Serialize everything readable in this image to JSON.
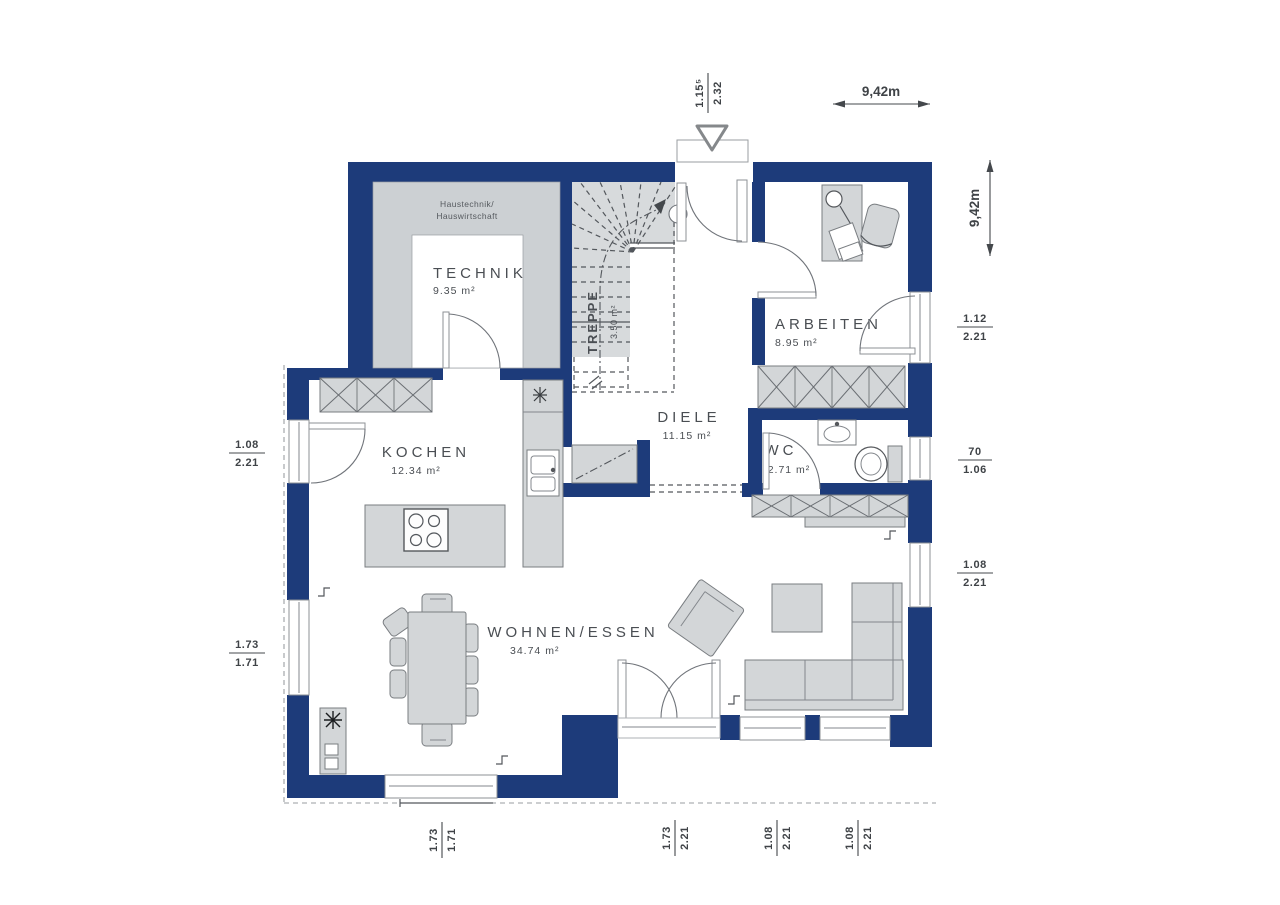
{
  "colors": {
    "wall": "#1d3b7a",
    "furn-fill": "#d3d6d8",
    "furn-stroke": "#797d81",
    "zone-fill": "#ccd0d3",
    "text": "#44484c"
  },
  "rooms": {
    "technik": {
      "name": "TECHNIK",
      "area": "9.35 m²"
    },
    "technik_note": {
      "line1": "Haustechnik/",
      "line2": "Hauswirtschaft"
    },
    "treppe": {
      "name": "TREPPE",
      "area": "3.50 m²"
    },
    "diele": {
      "name": "DIELE",
      "area": "11.15 m²"
    },
    "arbeiten": {
      "name": "ARBEITEN",
      "area": "8.95 m²"
    },
    "wc": {
      "name": "WC",
      "area": "2.71 m²"
    },
    "kochen": {
      "name": "KOCHEN",
      "area": "12.34 m²"
    },
    "wohnen_essen": {
      "name": "WOHNEN/ESSEN",
      "area": "34.74 m²"
    }
  },
  "overall": {
    "width": "9,42m",
    "height": "9,42m"
  },
  "openings": {
    "entry": {
      "num": "1.15⁵",
      "den": "2.32"
    },
    "right_arbeiten": {
      "num": "1.12",
      "den": "2.21"
    },
    "right_wc": {
      "num": "70",
      "den": "1.06"
    },
    "right_wohnen": {
      "num": "1.08",
      "den": "2.21"
    },
    "left_kochen": {
      "num": "1.08",
      "den": "2.21"
    },
    "left_wohnen": {
      "num": "1.73",
      "den": "1.71"
    },
    "bottom_terrace_left": {
      "num": "1.73",
      "den": "1.71"
    },
    "bottom_door": {
      "num": "1.73",
      "den": "2.21"
    },
    "bottom_window_1": {
      "num": "1.08",
      "den": "2.21"
    },
    "bottom_window_2": {
      "num": "1.08",
      "den": "2.21"
    }
  }
}
